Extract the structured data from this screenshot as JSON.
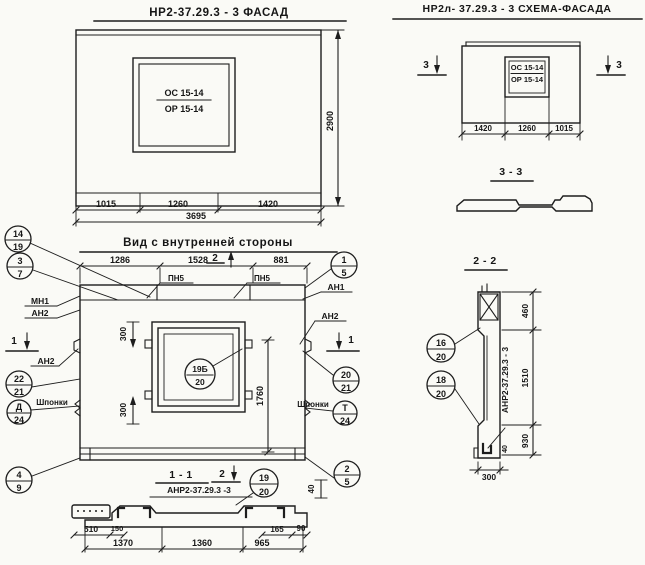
{
  "titles": {
    "facade": "НР2-37.29.3 - 3   ФАСАД",
    "schema": "НР2л- 37.29.3 - 3  СХЕМА-ФАСАДА",
    "inner": "Вид с внутренней стороны",
    "s11": "1 - 1",
    "s22": "2 - 2",
    "s33": "3 - 3",
    "s11_sub": "АНР2-37.29.3 -3",
    "s22_label": "АНР2-37.29.3 - 3"
  },
  "window_mark": {
    "top": "ОС 15-14",
    "bottom": "ОР 15-14"
  },
  "facade_dims": {
    "a": "1015",
    "b": "1260",
    "c": "1420",
    "total": "3695",
    "h": "2900"
  },
  "schema_dims": {
    "a": "1420",
    "b": "1260",
    "c": "1015",
    "cut": "3"
  },
  "inner_dims": {
    "a": "1286",
    "b": "1528",
    "c": "881",
    "v300": "300",
    "v1760": "1760",
    "v40": "40"
  },
  "labels": {
    "pn5": "ПН5",
    "mn1": "МН1",
    "an1": "АН1",
    "an2": "АН2",
    "shponki": "Шпонки",
    "cut1": "1",
    "cut2": "2"
  },
  "callouts": {
    "c14_19": {
      "t": "14",
      "b": "19"
    },
    "c3_7": {
      "t": "3",
      "b": "7"
    },
    "c22_21": {
      "t": "22",
      "b": "21"
    },
    "cd_24": {
      "t": "Д",
      "b": "24"
    },
    "c4_9": {
      "t": "4",
      "b": "9"
    },
    "c1_5": {
      "t": "1",
      "b": "5"
    },
    "c20_21": {
      "t": "20",
      "b": "21"
    },
    "ct_24": {
      "t": "Т",
      "b": "24"
    },
    "c2_5": {
      "t": "2",
      "b": "5"
    },
    "c19b_20": {
      "t": "19Б",
      "b": "20"
    },
    "c19_20": {
      "t": "19",
      "b": "20"
    },
    "c16_20": {
      "t": "16",
      "b": "20"
    },
    "c18_20": {
      "t": "18",
      "b": "20"
    }
  },
  "s11_dims": {
    "d510": "510",
    "d150": "150",
    "d1370": "1370",
    "d1360": "1360",
    "d965": "965",
    "d165": "165",
    "d90": "90"
  },
  "s22_dims": {
    "d460": "460",
    "d1510": "1510",
    "d930": "930",
    "d40": "40",
    "d300": "300"
  }
}
